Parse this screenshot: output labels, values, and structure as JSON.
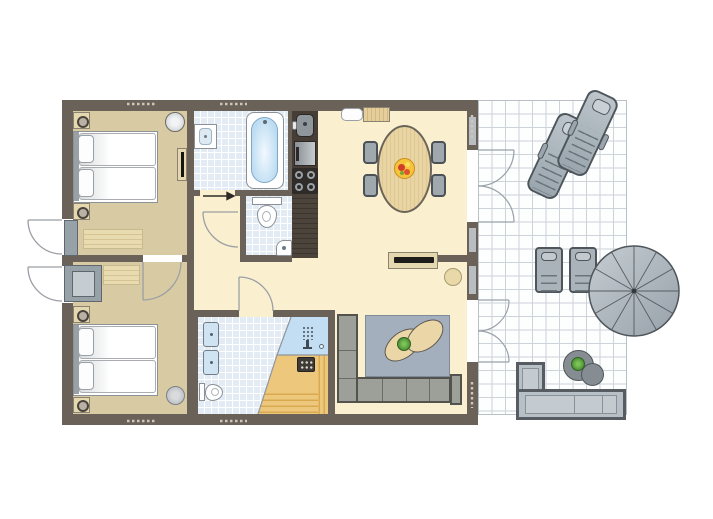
{
  "document": {
    "kind": "holiday-home floor plan, top-down architectural drawing",
    "text_labels": "none visible in image"
  },
  "palette": {
    "wall": "#6a6158",
    "bedroom_floor": "#d8caa2",
    "living_floor": "#faf0cf",
    "bathroom_tile": "#e3ecf4",
    "shower_tile": "#c3def2",
    "sauna_wood": "#edc77c",
    "kitchen_counter": "#4a4139",
    "furniture_grey": "#9fa8ad",
    "outdoor_grey": "#aab3b9",
    "rug_indoor": "#a3afbc",
    "wood_table": "#e9d5a4",
    "plant_green": "#57a33b",
    "terrace_grid_line": "#ccd3d9",
    "door_arc": "#9b9fa5"
  },
  "rooms": [
    {
      "name": "bedroom-1",
      "floor": "tan",
      "furniture": [
        "double bed with two pillows",
        "nightstand with lamp x2",
        "round wall mirror",
        "wall TV panel",
        "striped rug",
        "entry mat"
      ]
    },
    {
      "name": "bedroom-2",
      "floor": "tan",
      "furniture": [
        "double bed with two pillows",
        "nightstand with lamp x2",
        "wardrobe box",
        "striped rug",
        "round stool"
      ]
    },
    {
      "name": "bathroom-1",
      "floor": "tile",
      "furniture": [
        "washbasin",
        "bathtub with faucet"
      ]
    },
    {
      "name": "wc",
      "floor": "tile",
      "furniture": [
        "toilet",
        "corner hand basin"
      ]
    },
    {
      "name": "bathroom-2",
      "floor": "tile",
      "furniture": [
        "double washbasin",
        "toilet",
        "walk-in shower with rain head"
      ]
    },
    {
      "name": "sauna",
      "floor": "wood",
      "furniture": [
        "sauna heater",
        "benches"
      ]
    },
    {
      "name": "kitchen",
      "floor": "counter",
      "furniture": [
        "sink unit",
        "appliance/fridge",
        "4-burner hob",
        "worktop"
      ]
    },
    {
      "name": "hallway",
      "floor": "cream",
      "furniture": [
        "entrance direction arrow"
      ]
    },
    {
      "name": "living-dining",
      "floor": "cream",
      "furniture": [
        "oval dining table",
        "dining chair x4",
        "fruit bowl",
        "wall bench",
        "doormat",
        "TV sideboard",
        "round pouf",
        "corner sofa",
        "blue-grey rug",
        "oval coffee table x2",
        "potted plant"
      ]
    },
    {
      "name": "terrace",
      "floor": "white grid tiles",
      "furniture": [
        "sun lounger x2",
        "outdoor chair x2",
        "round side table x2",
        "potted plant",
        "parasol",
        "L-shaped outdoor sofa"
      ]
    }
  ],
  "doors": [
    "two exterior single doors on left wall swinging outward",
    "interior door hallway to bedroom-2",
    "interior door hallway to wc",
    "interior door hallway to bathroom-2",
    "sliding door to bathroom-1 (arrow marker)",
    "double french doors living room to terrace (upper)",
    "double french doors living room to terrace (lower)"
  ]
}
